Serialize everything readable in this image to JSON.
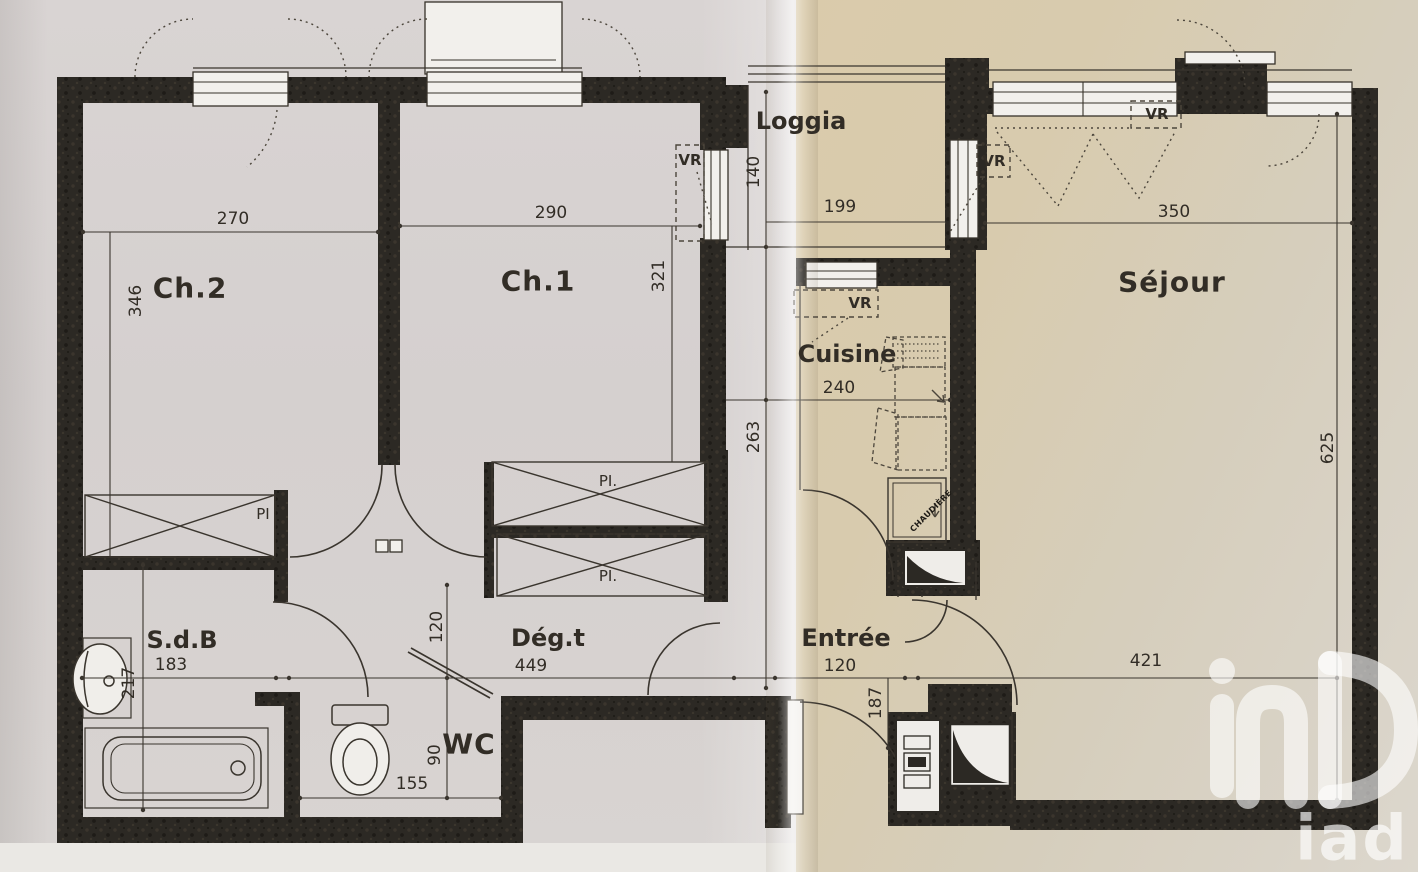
{
  "watermark": {
    "brand": "iad"
  },
  "rooms": {
    "ch2": {
      "name": "Ch.2",
      "width": "270",
      "depth": "346"
    },
    "ch1": {
      "name": "Ch.1",
      "width": "290",
      "depth": "321"
    },
    "loggia": {
      "name": "Loggia",
      "width": "199",
      "depth": "140"
    },
    "sejour": {
      "name": "Séjour",
      "width_top": "350",
      "width_bottom": "421",
      "depth": "625"
    },
    "cuisine": {
      "name": "Cuisine",
      "width": "240",
      "depth": "263"
    },
    "sdb": {
      "name": "S.d.B",
      "width": "183",
      "depth": "217"
    },
    "degagement": {
      "name": "Dég.t",
      "width": "449",
      "depth": "120"
    },
    "wc": {
      "name": "WC",
      "width": "155",
      "depth": "90"
    },
    "entree": {
      "name": "Entrée",
      "width": "120",
      "depth": "187"
    }
  },
  "annotations": {
    "roller_shutter_abbr": "VR",
    "closet_abbr": "PI",
    "closet_abbr_dotted": "PI.",
    "boiler_label": "CHAUDIÈRE"
  },
  "colors": {
    "paper_left": "#d7d2d1",
    "paper_right": "#d9cbae",
    "wall": "#2c2924",
    "ink": "#38332c",
    "watermark": "rgba(255,255,255,0.6)"
  }
}
